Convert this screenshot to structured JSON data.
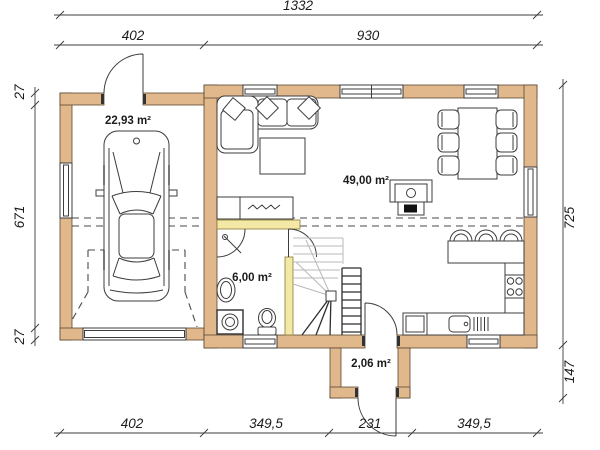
{
  "dims": {
    "total_width": "1332",
    "garage_width": "402",
    "house_width": "930",
    "left_wall_top": "27",
    "left_height": "671",
    "left_wall_bottom": "27",
    "right_height": "725",
    "entry_depth": "147",
    "bottom_garage": "402",
    "bottom_house_left": "349,5",
    "bottom_entry": "231",
    "bottom_house_right": "349,5"
  },
  "rooms": {
    "garage_area": "22,93 m²",
    "living_area": "49,00 m²",
    "bathroom_area": "6,00 m²",
    "entry_area": "2,06 m²"
  },
  "colors": {
    "wall-fill": "#e0b88c",
    "wall-stroke": "#5c4733",
    "partition-fill": "#f3e8a6",
    "line": "#3c3c3c"
  }
}
